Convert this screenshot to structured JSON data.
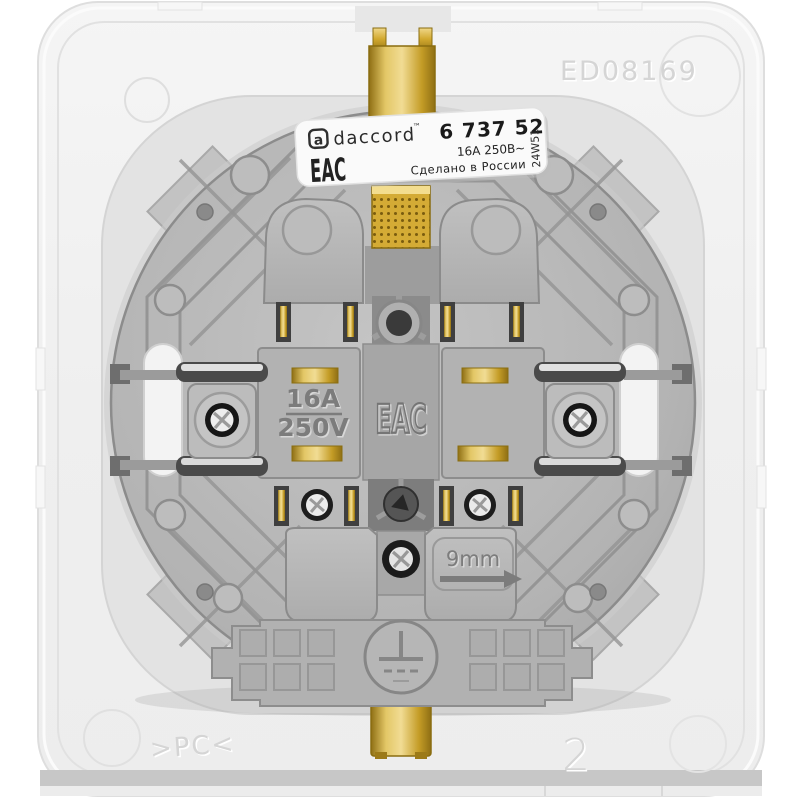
{
  "image": {
    "type": "product-photo",
    "subject": "Back side of a daccord flush-mount wall socket mechanism with white mounting frame",
    "background_color": "#ffffff"
  },
  "frame_markings": {
    "top_right_code": "ED08169",
    "bottom_left_material": ">PC<",
    "bottom_right_number": "2"
  },
  "label": {
    "logo_glyph": "a",
    "brand": "daccord",
    "trademark": "™",
    "reference_number": "6 737 52",
    "eac_mark": "EAC",
    "rating": "16A 250В~",
    "origin": "Сделано в России",
    "batch_code": "24W51"
  },
  "molded_markings": {
    "current": "16A",
    "voltage": "250V",
    "eac_mark": "EAC",
    "strip_length": "9mm"
  },
  "colors": {
    "frame_plastic": "#f0f0f0",
    "mechanism_plastic": "#b3b3b3",
    "brass": "#d2a92f",
    "label_background": "#fafafa",
    "metal_screw": "#e8e8e8"
  }
}
